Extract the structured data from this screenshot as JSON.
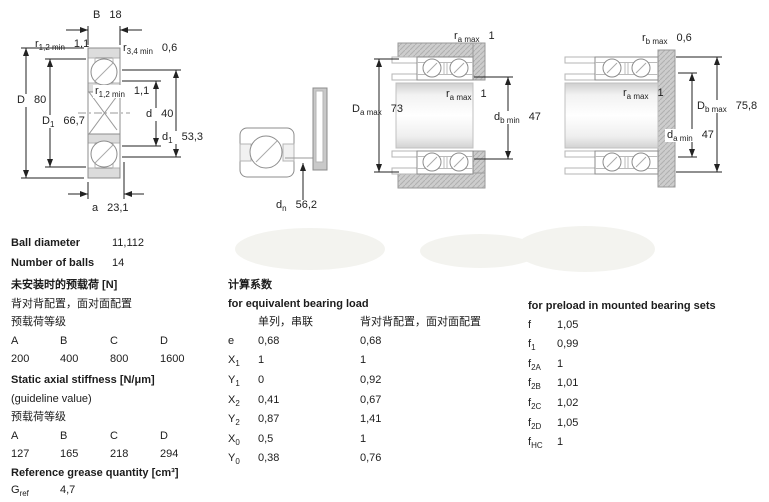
{
  "drawings": {
    "d1": {
      "labels": [
        {
          "b": "B",
          "s": "",
          "v": "18"
        },
        {
          "b": "r",
          "s": "1,2 min",
          "v": "1,1"
        },
        {
          "b": "r",
          "s": "3,4 min",
          "v": "0,6"
        },
        {
          "b": "D",
          "s": "",
          "v": "80"
        },
        {
          "b": "D",
          "s": "1",
          "v": "66,7"
        },
        {
          "b": "r",
          "s": "1,2 min",
          "v": "1,1"
        },
        {
          "b": "d",
          "s": "",
          "v": "40"
        },
        {
          "b": "d",
          "s": "1",
          "v": "53,3"
        },
        {
          "b": "a",
          "s": "",
          "v": "23,1"
        }
      ]
    },
    "d2": {
      "labels": [
        {
          "b": "d",
          "s": "n",
          "v": "56,2"
        }
      ]
    },
    "d3": {
      "labels": [
        {
          "b": "r",
          "s": "a max",
          "v": "1"
        },
        {
          "b": "r",
          "s": "a max",
          "v": "1"
        },
        {
          "b": "D",
          "s": "a max",
          "v": "73"
        },
        {
          "b": "d",
          "s": "b min",
          "v": "47"
        }
      ]
    },
    "d4": {
      "labels": [
        {
          "b": "r",
          "s": "b max",
          "v": "0,6"
        },
        {
          "b": "r",
          "s": "a max",
          "v": "1"
        },
        {
          "b": "D",
          "s": "b max",
          "v": "75,8"
        },
        {
          "b": "d",
          "s": "a min",
          "v": "47"
        }
      ]
    }
  },
  "specs": {
    "ball_diameter": {
      "label": "Ball diameter",
      "value": "11,112"
    },
    "number_of_balls": {
      "label": "Number of balls",
      "value": "14"
    }
  },
  "preload_unmounted": {
    "title_zh": "未安装时的预载荷 [N]",
    "line1": "背对背配置，面对面配置",
    "line2": "预载荷等级",
    "headers": [
      "A",
      "B",
      "C",
      "D"
    ],
    "values": [
      "200",
      "400",
      "800",
      "1600"
    ]
  },
  "stiffness": {
    "title": "Static axial stiffness [N/μm]",
    "line1": "(guideline value)",
    "line2": "预载荷等级",
    "headers": [
      "A",
      "B",
      "C",
      "D"
    ],
    "values": [
      "127",
      "165",
      "218",
      "294"
    ]
  },
  "grease": {
    "title": "Reference grease quantity [cm³]",
    "symbol": {
      "b": "G",
      "s": "ref"
    },
    "value": "4,7"
  },
  "calc_factors": {
    "title_zh": "计算系数",
    "title_en": "for equivalent bearing load",
    "col1": "单列，串联",
    "col2": "背对背配置，面对面配置",
    "rows": [
      {
        "b": "e",
        "s": "",
        "v1": "0,68",
        "v2": "0,68"
      },
      {
        "b": "X",
        "s": "1",
        "v1": "1",
        "v2": "1"
      },
      {
        "b": "Y",
        "s": "1",
        "v1": "0",
        "v2": "0,92"
      },
      {
        "b": "X",
        "s": "2",
        "v1": "0,41",
        "v2": "0,67"
      },
      {
        "b": "Y",
        "s": "2",
        "v1": "0,87",
        "v2": "1,41"
      },
      {
        "b": "X",
        "s": "0",
        "v1": "0,5",
        "v2": "1"
      },
      {
        "b": "Y",
        "s": "0",
        "v1": "0,38",
        "v2": "0,76"
      }
    ]
  },
  "preload_factors": {
    "title": "for preload in mounted bearing sets",
    "rows": [
      {
        "b": "f",
        "s": "",
        "v": "1,05"
      },
      {
        "b": "f",
        "s": "1",
        "v": "0,99"
      },
      {
        "b": "f",
        "s": "2A",
        "v": "1"
      },
      {
        "b": "f",
        "s": "2B",
        "v": "1,01"
      },
      {
        "b": "f",
        "s": "2C",
        "v": "1,02"
      },
      {
        "b": "f",
        "s": "2D",
        "v": "1,05"
      },
      {
        "b": "f",
        "s": "HC",
        "v": "1"
      }
    ]
  }
}
